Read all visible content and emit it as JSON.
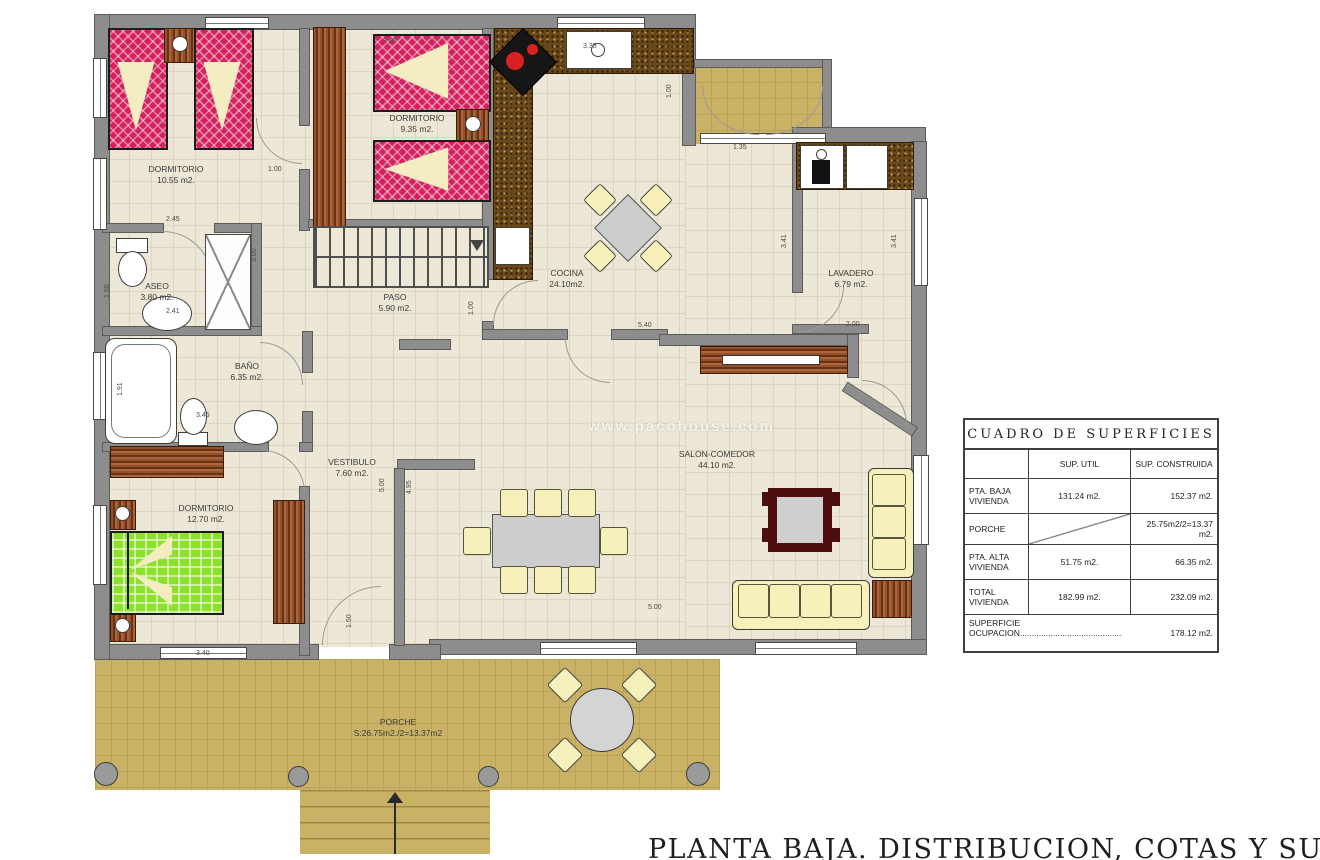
{
  "watermark": "www.pacohouse.com",
  "footer_title": "PLANTA BAJA. DISTRIBUCION, COTAS Y SUPERFICIES",
  "rooms": [
    {
      "name": "DORMITORIO",
      "area": "10.55 m2."
    },
    {
      "name": "DORMITORIO",
      "area": "9.35 m2."
    },
    {
      "name": "COCINA",
      "area": "24.10m2."
    },
    {
      "name": "LAVADERO",
      "area": "6.79 m2."
    },
    {
      "name": "ASEO",
      "area": "3.80 m2."
    },
    {
      "name": "PASO",
      "area": "5.90 m2."
    },
    {
      "name": "BAÑO",
      "area": "6.35 m2."
    },
    {
      "name": "VESTIBULO",
      "area": "7.60 m2."
    },
    {
      "name": "DORMITORIO",
      "area": "12.70 m2."
    },
    {
      "name": "SALON-COMEDOR",
      "area": "44.10 m2."
    },
    {
      "name": "PORCHE",
      "area": "S:26.75m2./2=13.37m2"
    }
  ],
  "dims": [
    "3.00",
    "3.35",
    "1.00",
    "1.35",
    "3.41",
    "3.41",
    "2.00",
    "1.00",
    "2.45",
    "3.00",
    "2.41",
    "1.50",
    "1.91",
    "3.45",
    "5.00",
    "4.95",
    "1.00",
    "5.40",
    "3.40",
    "5.00",
    "1.50"
  ],
  "table": {
    "title": "CUADRO DE SUPERFICIES",
    "col_util": "SUP. UTIL",
    "col_constr": "SUP. CONSTRUIDA",
    "rows": [
      {
        "label": "PTA. BAJA VIVIENDA",
        "util": "131.24 m2.",
        "constr": "152.37 m2."
      },
      {
        "label": "PORCHE",
        "util": "",
        "constr": "25.75m2/2=13.37 m2."
      },
      {
        "label": "PTA. ALTA VIVIENDA",
        "util": "51.75 m2.",
        "constr": "66.35 m2."
      },
      {
        "label": "TOTAL VIVIENDA",
        "util": "182.99 m2.",
        "constr": "232.09 m2."
      }
    ],
    "footer": {
      "label1": "SUPERFICIE",
      "label2": "OCUPACION...........................................",
      "value": "178.12 m2."
    }
  }
}
